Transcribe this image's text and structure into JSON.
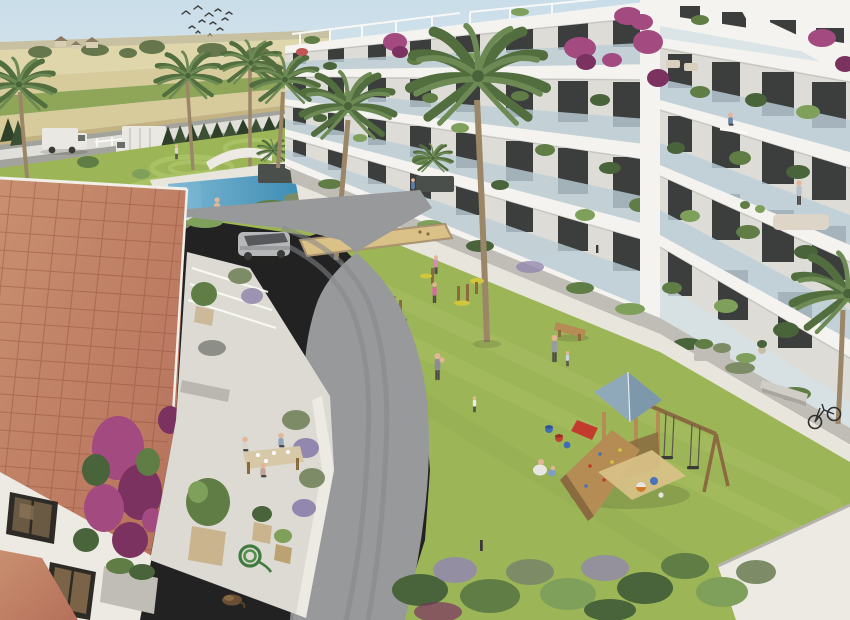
{
  "image": {
    "kind": "3d-architectural-rendering",
    "view": "aerial",
    "subject": "Mediterranean residential apartment complex with landscaped courtyard"
  },
  "colors": {
    "sky1": "#c9dde9",
    "sky2": "#eef1ef",
    "field1": "#d7cb9c",
    "field2": "#c3b383",
    "field3": "#8fa659",
    "field4": "#e0d6ac",
    "hilltree": "#5d6f45",
    "housetan": "#d9cdb4",
    "wall": "#eceae3",
    "backroad": "#a3a39e",
    "cypress": "#3c5134",
    "cypress2": "#2e4128",
    "lawn": "#9cb657",
    "lawnlt": "#aec46a",
    "lawndk": "#88a44b",
    "mow": "#b6cc74",
    "deck": "#e8e5dc",
    "pool": "#3e8db4",
    "poollt": "#7db8d4",
    "planterdk": "#4a4f4c",
    "bldg": "#f4f3ef",
    "bldg2": "#e6e5df",
    "slabshadow": "#c9cbc7",
    "recess": "#dddcd6",
    "win": "#3b3e3d",
    "winlt": "#6a6e6b",
    "glass": "#bdcfd8",
    "glasslt": "#d6e2e7",
    "green1": "#5f7d45",
    "green2": "#49633a",
    "green3": "#7fa05b",
    "bougainvillea": "#a34a80",
    "bougainvillea2": "#7c3260",
    "lavender": "#9287ae",
    "lavendergreen": "#7d8c66",
    "roof": "#b5705a",
    "roofdk": "#93503d",
    "rooflt": "#c98f70",
    "terrace": "#dcdad3",
    "terracedark": "#bfbdb6",
    "road": "#98999a",
    "roaddark": "#85868a",
    "roadlight": "#a7a8a6",
    "wood": "#b58d54",
    "wooddark": "#8a6a3e",
    "playroof": "#8fa9ba",
    "playroof2": "#7d98aa",
    "sand": "#d9c188",
    "suv": "#b5b7b9",
    "suvdark": "#46484b",
    "red": "#c23b2d",
    "truck": "#eae8e3",
    "skin": "#e3b697",
    "yellow": "#d2c63d",
    "palmtrunk": "#9b8668",
    "palm1": "#6d8a55",
    "palm2": "#526e3e",
    "dark": "#3a3a38"
  },
  "scene": {
    "sky": {
      "birds": 12
    },
    "background": {
      "farmland_fields": 6,
      "farmhouses": 3,
      "cypress_hedge_trees": 15,
      "perimeter_fence": true,
      "vehicles": [
        "white-van",
        "box-truck",
        "red-car"
      ]
    },
    "palm_trees": 9,
    "amenities": {
      "swimming_pool": {
        "swimmers": 2
      },
      "petanque_court": 1,
      "outdoor_gym_stations": 5,
      "playground": {
        "tower_roof": "blue-gray",
        "swings": 2,
        "slide": "red",
        "climbing_wall": 1,
        "balls": 3,
        "buckets": 3
      },
      "benches": 3,
      "bicycle": 1,
      "path_lights": 4
    },
    "buildings": {
      "apartment_blocks": 2,
      "floors_visible": 5,
      "balconies": "white slabs with glass balustrades, potted plants and bougainvillea",
      "rooftop_pergolas": true
    },
    "foreground_house": {
      "roof": "terracotta tile",
      "windows": 2,
      "terrace_diners": 3,
      "potted_plants": 6,
      "garden_hose": 1,
      "sleeping_cat": 1,
      "bougainvillea": true
    },
    "courtyard_people": 9,
    "balcony_people": 2,
    "pool_area_people": 4,
    "inner_vehicle": "silver-suv"
  }
}
